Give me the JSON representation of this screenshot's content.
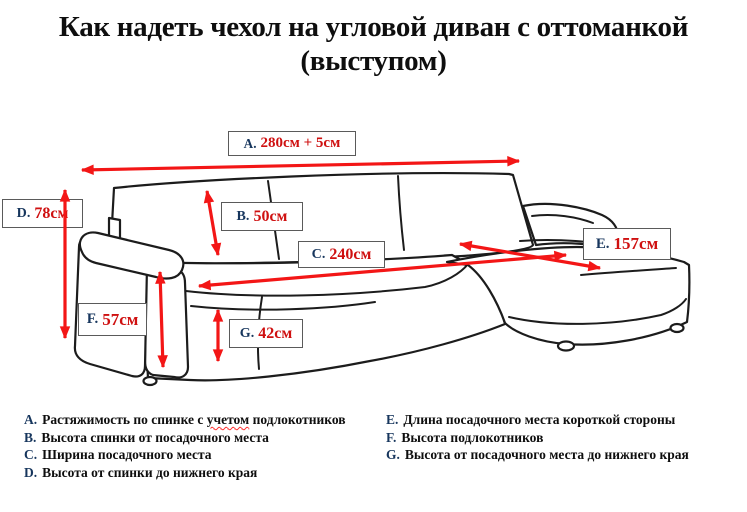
{
  "title": {
    "line1": "Как надеть чехол на угловой диван с оттоманкой",
    "line2": "(выступом)"
  },
  "measurements": [
    {
      "letter": "A.",
      "value": "280см + 5см"
    },
    {
      "letter": "B.",
      "value": "50см"
    },
    {
      "letter": "C.",
      "value": "240см"
    },
    {
      "letter": "D.",
      "value": "78см"
    },
    {
      "letter": "E.",
      "value": "157см"
    },
    {
      "letter": "F.",
      "value": "57см"
    },
    {
      "letter": "G.",
      "value": "42см"
    }
  ],
  "legend": {
    "left": [
      {
        "letter": "A.",
        "before": "Растяжимость по спинке с ",
        "word": "учетом",
        "after": " подлокотников"
      },
      {
        "letter": "B.",
        "text": "Высота спинки от посадочного места"
      },
      {
        "letter": "C.",
        "text": "Ширина посадочного места"
      },
      {
        "letter": "D.",
        "text": "Высота от спинки до нижнего края"
      }
    ],
    "right": [
      {
        "letter": "E.",
        "text": "Длина посадочного места короткой стороны"
      },
      {
        "letter": "F.",
        "text": "Высота подлокотников"
      },
      {
        "letter": "G.",
        "text": "Высота от посадочного места до нижнего края"
      }
    ]
  },
  "colors": {
    "arrow": "#f31616",
    "value": "#cf1010",
    "prefix": "#17365d",
    "border": "#5a5a5a",
    "outline": "#1c1c1c"
  }
}
